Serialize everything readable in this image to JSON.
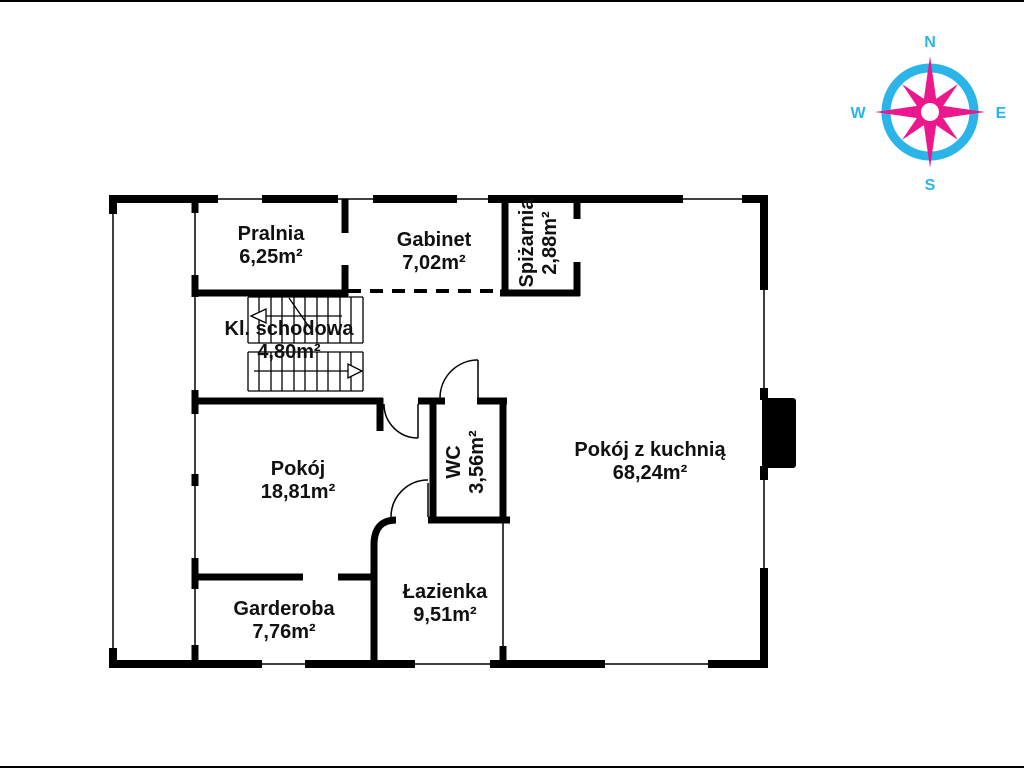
{
  "plan_title": "floor-plan",
  "rooms": [
    {
      "name": "Pralnia",
      "area": "6,25m²"
    },
    {
      "name": "Gabinet",
      "area": "7,02m²"
    },
    {
      "name": "Spiżarnia",
      "area": "2,88m²"
    },
    {
      "name": "Kl. schodowa",
      "area": "4,80m²"
    },
    {
      "name": "Pokój",
      "area": "18,81m²"
    },
    {
      "name": "WC",
      "area": "3,56m²"
    },
    {
      "name": "Pokój z kuchnią",
      "area": "68,24m²"
    },
    {
      "name": "Garderoba",
      "area": "7,76m²"
    },
    {
      "name": "Łazienka",
      "area": "9,51m²"
    }
  ],
  "compass": {
    "north": "N",
    "south": "S",
    "east": "E",
    "west": "W"
  },
  "colors": {
    "wall": "#000000",
    "compass_ring": "#2bb4e8",
    "compass_star": "#ec168d",
    "compass_text": "#2bb4e8"
  }
}
